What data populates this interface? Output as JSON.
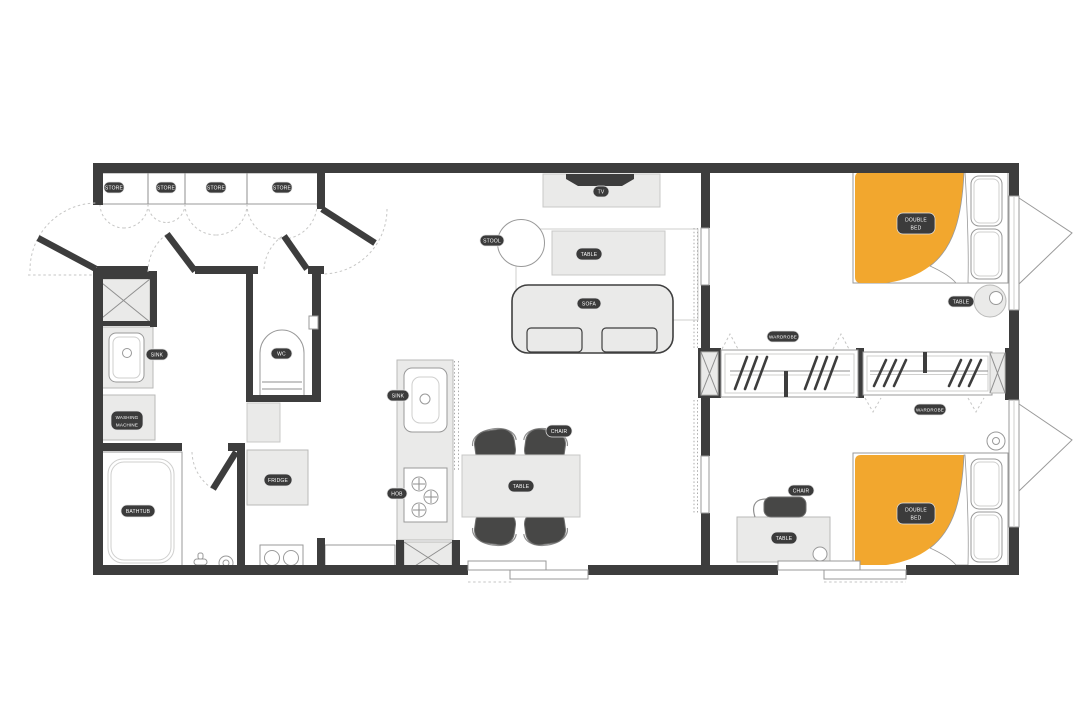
{
  "floor_plan": {
    "labels": {
      "store": "STORE",
      "sink": "SINK",
      "washing": "WASHING",
      "machine": "MACHINE",
      "bathtub": "BATHTUB",
      "wc": "WC",
      "fridge": "FRIDGE",
      "hob": "HOB",
      "stool": "STOOL",
      "table": "TABLE",
      "sofa": "SOFA",
      "tv": "TV",
      "chair": "CHAIR",
      "wardrobe": "WARDROBE",
      "double": "DOUBLE",
      "bed": "BED"
    },
    "colors": {
      "wall": "#3d3d3d",
      "bed_accent": "#f2a72e",
      "furniture_fill": "#eaeae9",
      "label_bg": "#3b3b3b",
      "label_text": "#ffffff"
    }
  }
}
